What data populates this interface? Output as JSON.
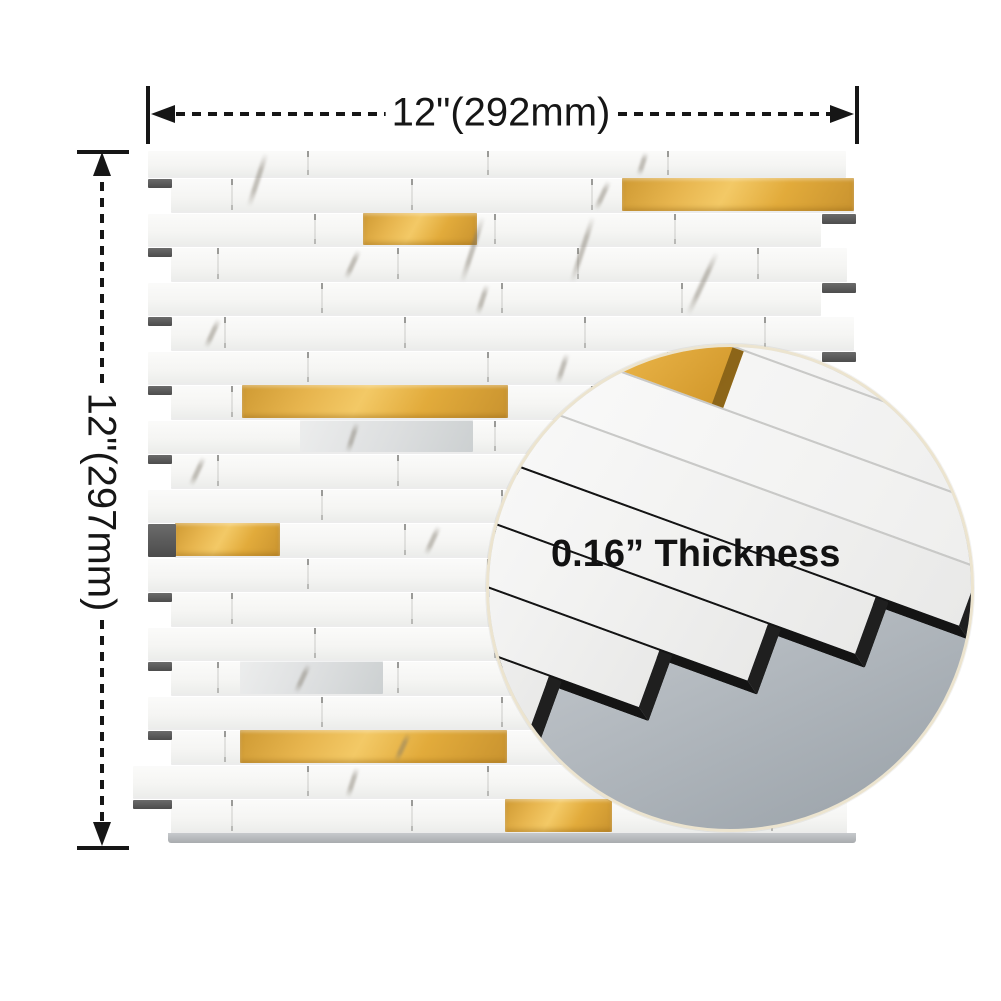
{
  "annotations": {
    "width_dimension": {
      "label": "12\"(292mm)"
    },
    "height_dimension": {
      "label": "12\"(297mm)"
    },
    "thickness_note": {
      "label": "0.16” Thickness"
    }
  },
  "colors": {
    "background": "#ffffff",
    "dimension_ink": "#161616",
    "gold_accent": "#e2ac41",
    "gold_dark": "#c9932f",
    "tile_white": "#f7f7f6",
    "grout_line": "#d8d8d6",
    "backing_dark": "#4c4c4c",
    "inset_ring": "#ece4cf",
    "inset_backing_gray": "#a3aab1",
    "panel_edge_gray": "#b3b6b9"
  },
  "panel": {
    "top": 150,
    "first_row_height": 28,
    "row_height": 34.5,
    "row_count": 20,
    "left_even": 148,
    "left_odd": 171,
    "left_overrides": {
      "11": 175,
      "18": 133
    },
    "right_even": 821,
    "rights_odd": [
      854,
      847
    ],
    "right_overrides": {
      "0": 846,
      "19": 847
    },
    "joints": {
      "step": 180,
      "offset_even": 307,
      "offset_odd": 217
    },
    "gold_accents": [
      {
        "row": 1,
        "x1": 622,
        "x2": 854
      },
      {
        "row": 2,
        "x1": 363,
        "x2": 477
      },
      {
        "row": 7,
        "x1": 242,
        "x2": 508
      },
      {
        "row": 11,
        "x1": 175,
        "x2": 280
      },
      {
        "row": 17,
        "x1": 240,
        "x2": 507
      },
      {
        "row": 19,
        "x1": 505,
        "x2": 612
      }
    ],
    "marble_accents": [
      {
        "row": 8,
        "x1": 300,
        "x2": 473
      },
      {
        "row": 15,
        "x1": 240,
        "x2": 383
      }
    ],
    "veins": [
      {
        "row": 0,
        "x": 255,
        "tall": true
      },
      {
        "row": 0,
        "x": 640
      },
      {
        "row": 1,
        "x": 600
      },
      {
        "row": 2,
        "x": 470,
        "tall": true
      },
      {
        "row": 2,
        "x": 580,
        "tall": true
      },
      {
        "row": 3,
        "x": 700,
        "tall": true
      },
      {
        "row": 3,
        "x": 350
      },
      {
        "row": 4,
        "x": 480
      },
      {
        "row": 5,
        "x": 210
      },
      {
        "row": 6,
        "x": 560
      },
      {
        "row": 7,
        "x": 600
      },
      {
        "row": 8,
        "x": 350
      },
      {
        "row": 9,
        "x": 195
      },
      {
        "row": 11,
        "x": 430
      },
      {
        "row": 13,
        "x": 530
      },
      {
        "row": 15,
        "x": 300
      },
      {
        "row": 17,
        "x": 400
      },
      {
        "row": 18,
        "x": 350
      }
    ],
    "left_stubs": [
      {
        "row": 1
      },
      {
        "row": 3
      },
      {
        "row": 5
      },
      {
        "row": 7
      },
      {
        "row": 9
      },
      {
        "row": 13
      },
      {
        "row": 15
      },
      {
        "row": 17
      },
      {
        "row": 11,
        "x1": 148,
        "x2": 176,
        "h": 33
      },
      {
        "row": 19,
        "x1": 133,
        "x2": 172
      }
    ],
    "right_stubs": [
      2,
      4,
      6,
      10,
      14,
      16
    ],
    "bottom_edge": {
      "x1": 168,
      "x2": 856,
      "y": 833,
      "h": 10
    }
  },
  "inset": {
    "rotation_deg": 20,
    "strip_left": -430,
    "strip_right_full": 430,
    "strips": [
      {
        "y": -289,
        "h": 60,
        "r": 430,
        "kind": "full"
      },
      {
        "y": -227,
        "h": 60,
        "r": 430,
        "kind": "full",
        "gold_to": -80
      },
      {
        "y": -165,
        "h": 60,
        "r": 430,
        "kind": "full"
      },
      {
        "y": -103,
        "h": 60,
        "r": 228,
        "kind": "cut"
      },
      {
        "y": -41,
        "h": 60,
        "r": 140,
        "kind": "cut"
      },
      {
        "y": 21,
        "h": 60,
        "r": 48,
        "kind": "cut"
      },
      {
        "y": 83,
        "h": 60,
        "r": -45,
        "kind": "cut"
      },
      {
        "y": 145,
        "h": 60,
        "r": -140,
        "kind": "cut"
      },
      {
        "y": 207,
        "h": 62,
        "r": -150,
        "kind": "big"
      }
    ],
    "label_pos": {
      "left": 62,
      "top": 186
    }
  }
}
